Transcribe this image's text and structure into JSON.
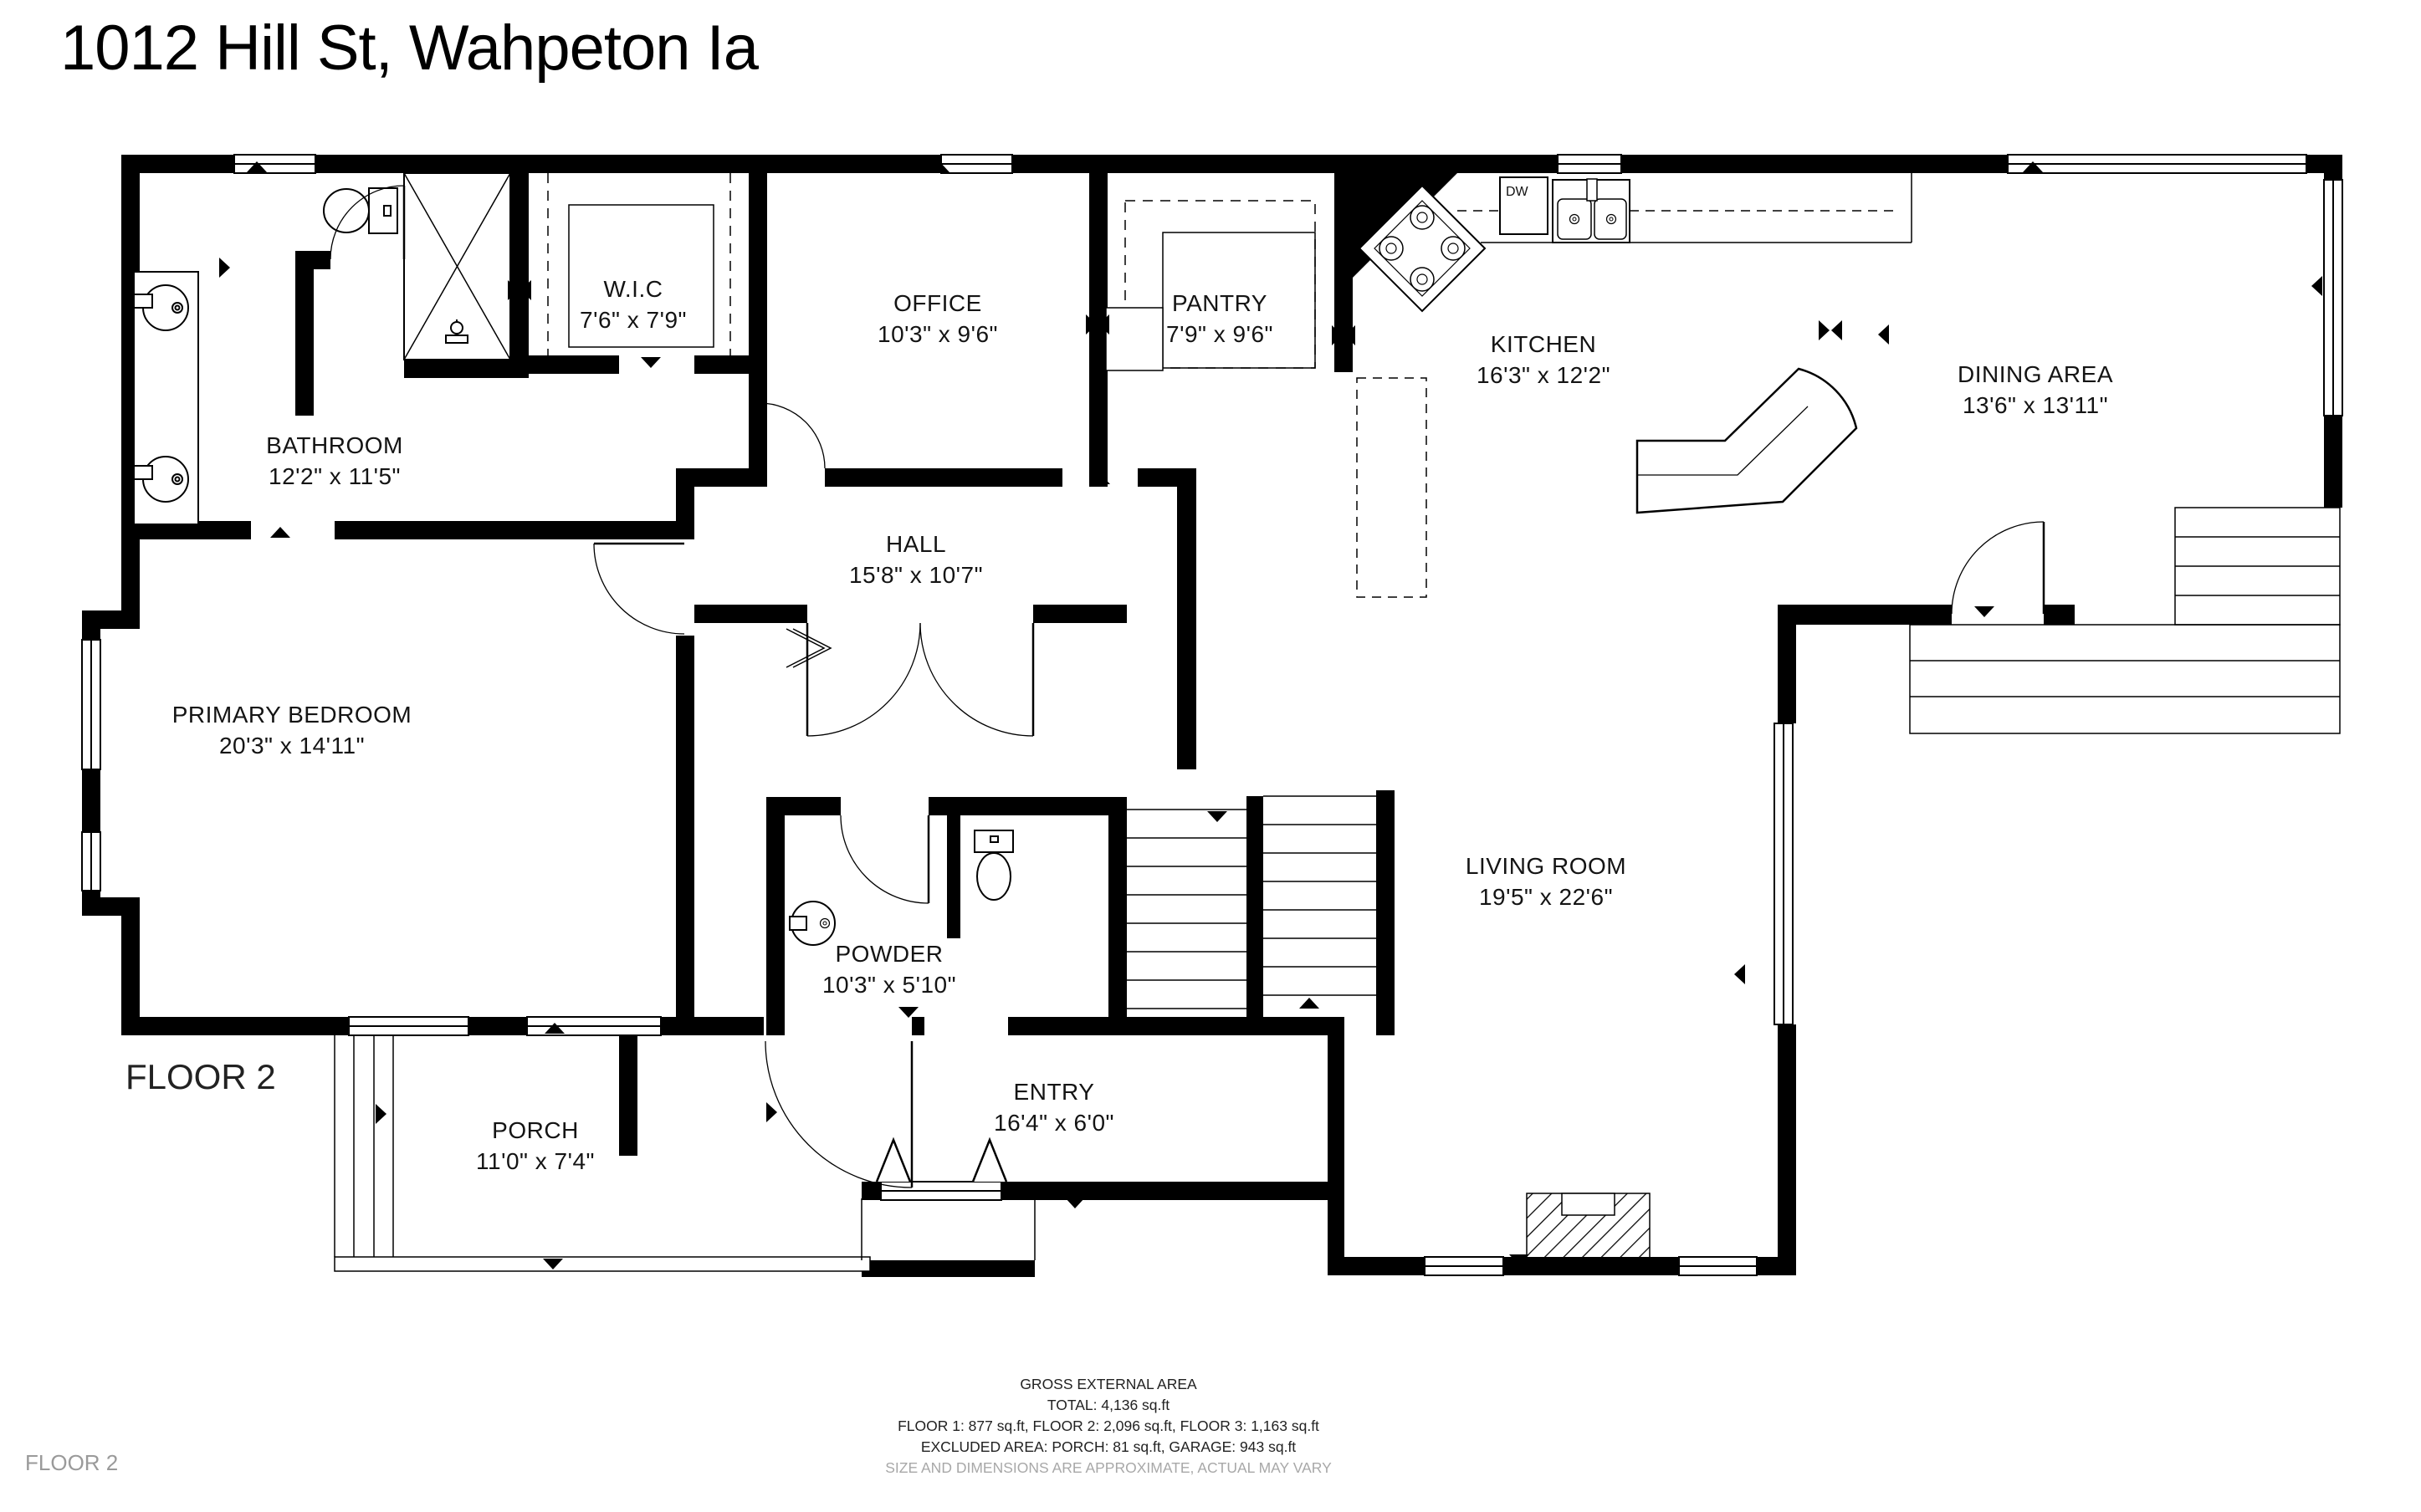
{
  "title": "1012 Hill St, Wahpeton Ia",
  "floor": {
    "big_label": "FLOOR 2",
    "small_label": "FLOOR 2"
  },
  "rooms": {
    "bathroom": {
      "name": "BATHROOM",
      "dims": "12'2\" x 11'5\""
    },
    "wic": {
      "name": "W.I.C",
      "dims": "7'6\" x 7'9\""
    },
    "office": {
      "name": "OFFICE",
      "dims": "10'3\" x 9'6\""
    },
    "pantry": {
      "name": "PANTRY",
      "dims": "7'9\" x 9'6\""
    },
    "kitchen": {
      "name": "KITCHEN",
      "dims": "16'3\" x 12'2\""
    },
    "dining": {
      "name": "DINING AREA",
      "dims": "13'6\" x 13'11\""
    },
    "hall": {
      "name": "HALL",
      "dims": "15'8\" x 10'7\""
    },
    "primary_bedroom": {
      "name": "PRIMARY BEDROOM",
      "dims": "20'3\" x 14'11\""
    },
    "powder": {
      "name": "POWDER",
      "dims": "10'3\" x 5'10\""
    },
    "living": {
      "name": "LIVING ROOM",
      "dims": "19'5\" x 22'6\""
    },
    "porch": {
      "name": "PORCH",
      "dims": "11'0\" x 7'4\""
    },
    "entry": {
      "name": "ENTRY",
      "dims": "16'4\" x 6'0\""
    }
  },
  "kitchen_labels": {
    "dishwasher": "DW"
  },
  "footer": {
    "heading": "GROSS EXTERNAL AREA",
    "total": "TOTAL: 4,136 sq.ft",
    "floors": "FLOOR 1: 877 sq.ft, FLOOR 2: 2,096 sq.ft, FLOOR 3: 1,163 sq.ft",
    "excluded": "EXCLUDED AREA: PORCH: 81 sq.ft, GARAGE: 943 sq.ft",
    "disclaimer": "SIZE AND DIMENSIONS ARE APPROXIMATE, ACTUAL MAY VARY"
  },
  "colors": {
    "wall": "#000000",
    "background": "#ffffff",
    "muted_text": "#9a9a9a"
  }
}
